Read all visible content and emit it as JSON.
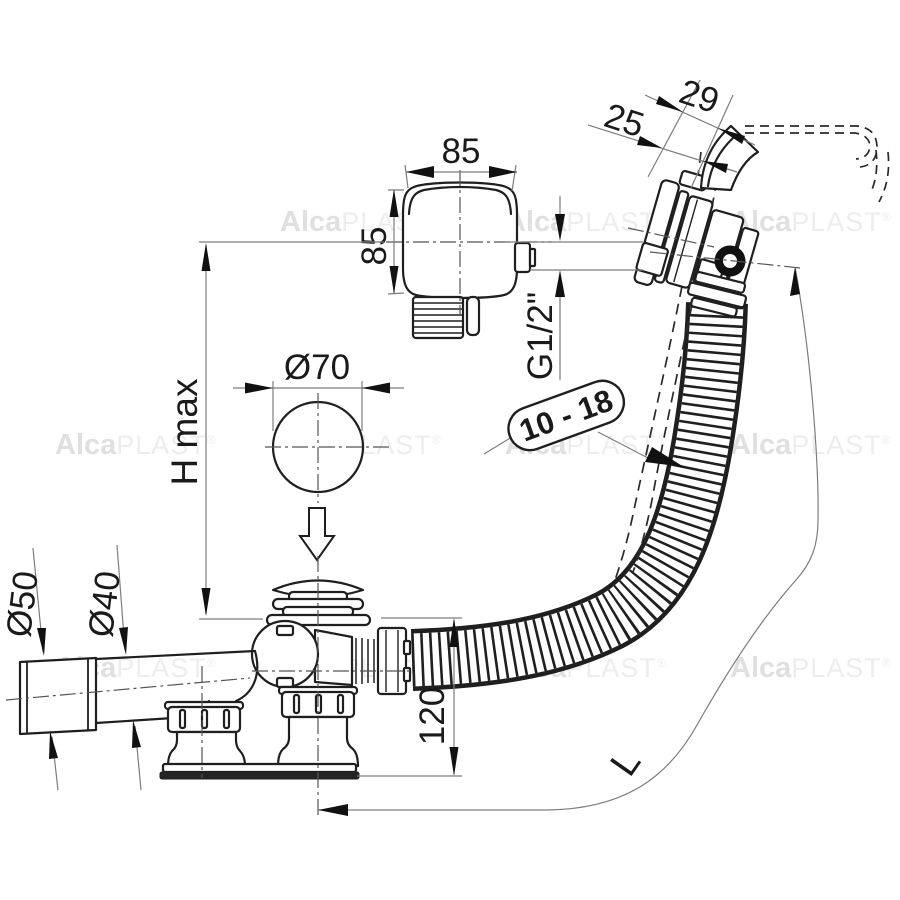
{
  "watermark": {
    "bold": "Alca",
    "light": "PLAST",
    "reg": "®"
  },
  "dims": {
    "box_width": "85",
    "box_height": "85",
    "overflow_offset": "29",
    "overflow_wall": "25",
    "thread": "G1/2\"",
    "tub_wall_range": "10 - 18",
    "plug_diameter": "Ø70",
    "height_max": "H max",
    "sleeve_diameter": "Ø50",
    "pipe_diameter": "Ø40",
    "body_height": "120",
    "hose_length": "L"
  },
  "colors": {
    "line": "#1f1f1f",
    "thin_line": "#7d7d7d",
    "watermark": "#e0e0e0",
    "background": "#ffffff"
  }
}
